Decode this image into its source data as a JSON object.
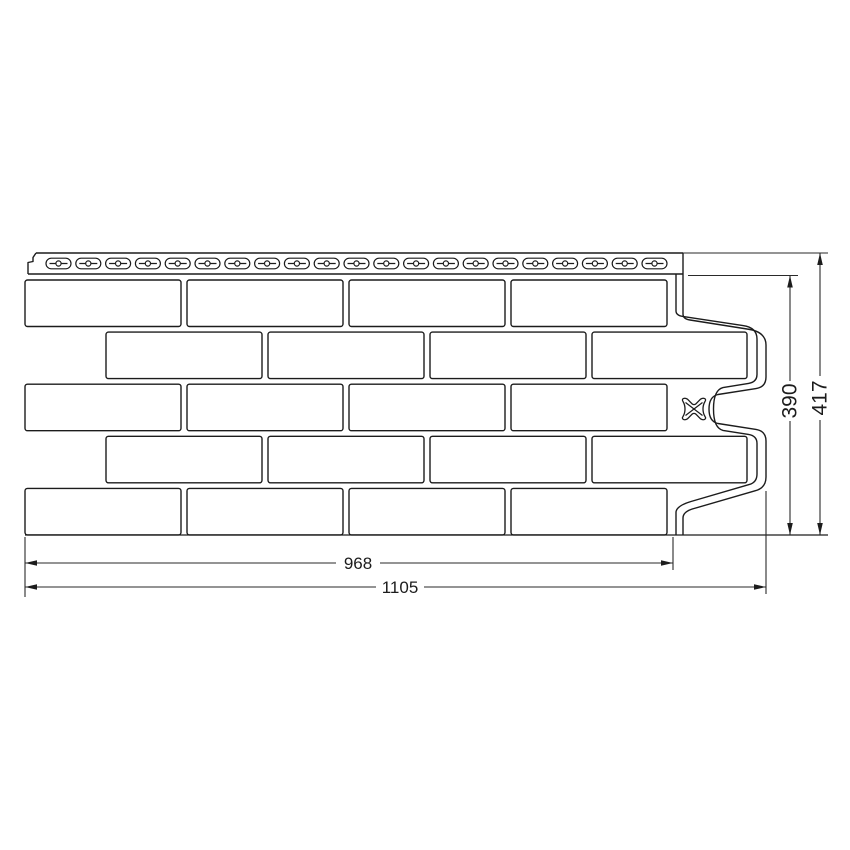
{
  "drawing": {
    "dim_useful_width": "968",
    "dim_total_width": "1105",
    "dim_useful_height": "390",
    "dim_total_height": "417",
    "brick_rows": 5,
    "bricks_per_row": 4,
    "nail_slots": 21
  },
  "colors": {
    "line": "#1c1c1c",
    "dim_line": "#2a2a2a",
    "background": "#ffffff"
  }
}
